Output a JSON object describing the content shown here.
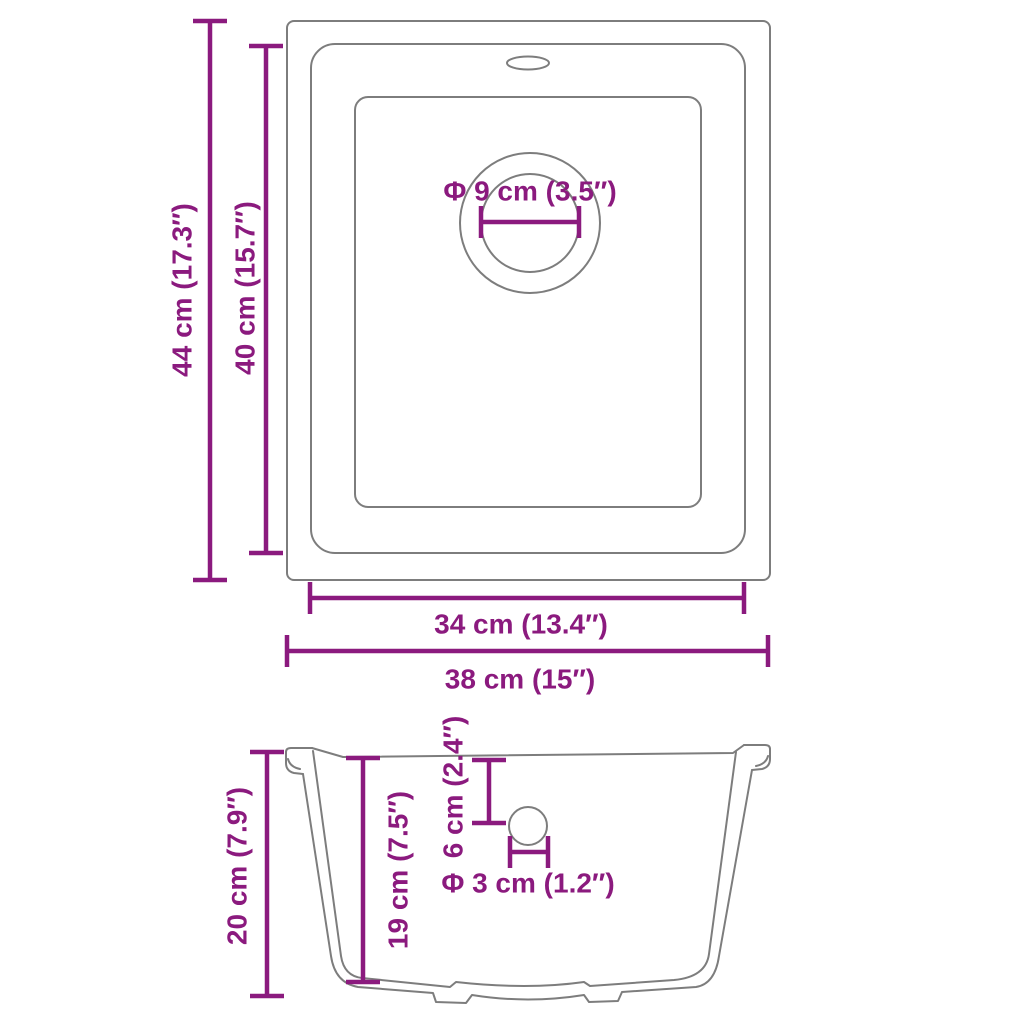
{
  "colors": {
    "dimension": "#8B1A7E",
    "outline": "#7D7D7D",
    "background": "#FFFFFF"
  },
  "top_view": {
    "outer_height_label": "44 cm (17.3″)",
    "inner_height_label": "40 cm (15.7″)",
    "inner_width_label": "34 cm (13.4″)",
    "outer_width_label": "38 cm (15″)",
    "drain_diameter_label": "Φ 9 cm (3.5″)"
  },
  "section_view": {
    "outer_depth_label": "20 cm (7.9″)",
    "inner_depth_label": "19 cm (7.5″)",
    "drain_offset_label": "6 cm (2.4″)",
    "drain_hole_diameter_label": "Φ 3 cm (1.2″)"
  }
}
